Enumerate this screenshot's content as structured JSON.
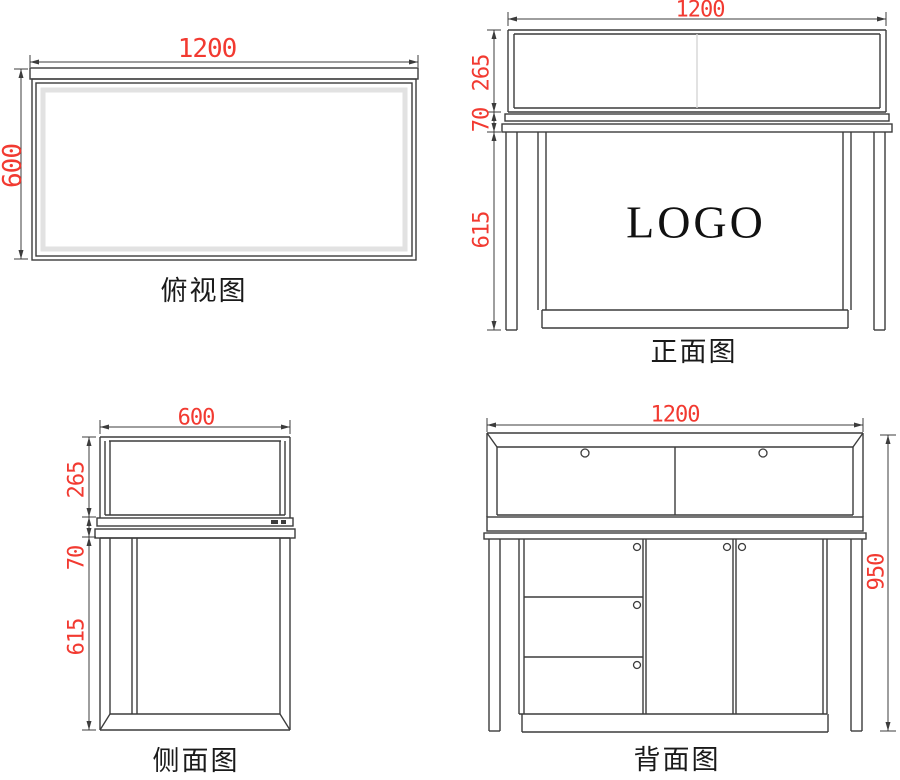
{
  "colors": {
    "line": "#3c3c3c",
    "dim": "#f23a31",
    "label": "#1a1a1a",
    "logo": "#111111",
    "glass_edge": "#e2e2e2",
    "glass_divider": "#d6d6d6",
    "background": "#ffffff"
  },
  "views": {
    "top": {
      "label": "俯视图",
      "dims": {
        "width": "1200",
        "depth": "600"
      }
    },
    "front": {
      "label": "正面图",
      "logo": "LOGO",
      "dims": {
        "width": "1200",
        "glass_height": "265",
        "counter_height": "70",
        "body_height": "615"
      }
    },
    "side": {
      "label": "侧面图",
      "dims": {
        "width": "600",
        "glass_height": "265",
        "counter_height": "70",
        "body_height": "615"
      }
    },
    "back": {
      "label": "背面图",
      "dims": {
        "width": "1200",
        "total_height": "950"
      }
    }
  }
}
